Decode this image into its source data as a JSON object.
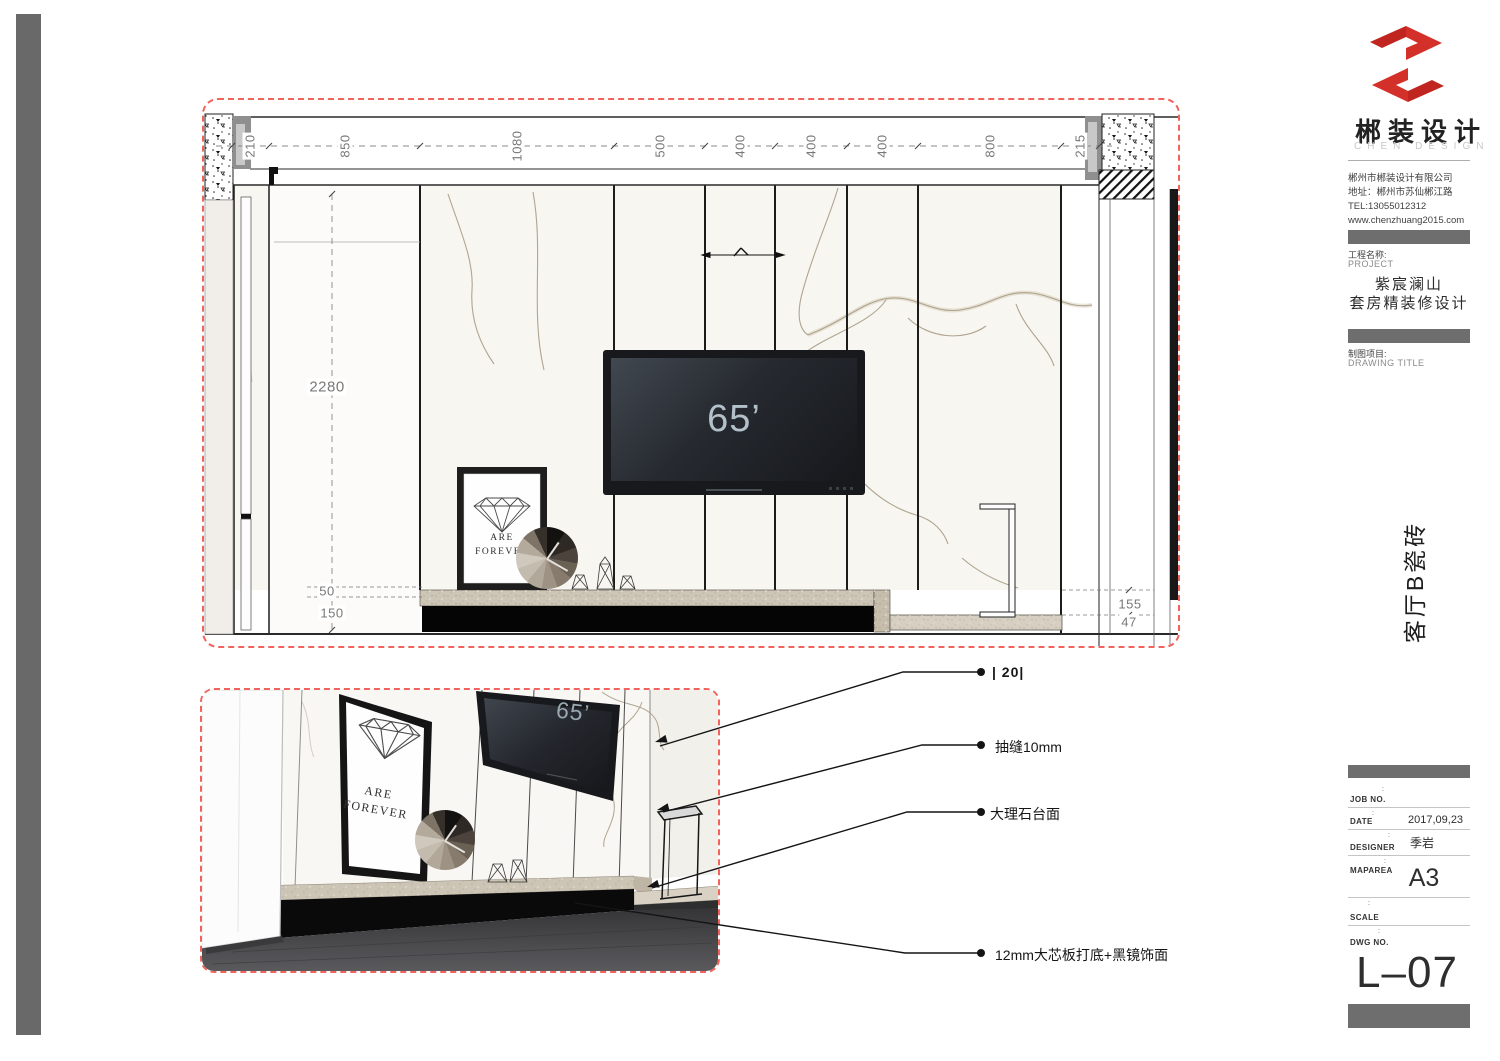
{
  "sidebar": {
    "brand": "郴装设计",
    "brand_en": "CHEN DESIGN",
    "company": [
      "郴州市郴装设计有限公司",
      "地址：郴州市苏仙郴江路",
      "TEL:13055012312",
      "www.chenzhuang2015.com"
    ],
    "project_label_cn": "工程名称:",
    "project_label_en": "PROJECT",
    "project_name": [
      "紫宸澜山",
      "套房精装修设计"
    ],
    "drawing_label_cn": "制图项目:",
    "drawing_label_en": "DRAWING TITLE",
    "drawing_title": "客厅B瓷砖",
    "titleblock": {
      "rows": [
        {
          "tick": ":",
          "label": "JOB NO.",
          "value": ""
        },
        {
          "tick": ":",
          "label": "DATE",
          "value": "2017,09,23"
        },
        {
          "tick": ":",
          "label": "DESIGNER",
          "value": "季岩"
        },
        {
          "tick": ":",
          "label": "MAPAREA",
          "value": "A3"
        },
        {
          "tick": ":",
          "label": "SCALE",
          "value": ""
        },
        {
          "tick": ":",
          "label": "DWG NO.",
          "value": ""
        }
      ],
      "dwg_number": "L–07"
    }
  },
  "elevation": {
    "dims_top": [
      "210",
      "850",
      "1080",
      "500",
      "400",
      "400",
      "400",
      "800",
      "215"
    ],
    "dim_height": "2280",
    "dim_counter_h1": "50",
    "dim_counter_h2": "150",
    "dim_right_1": "155",
    "dim_right_2": "47",
    "tv_label": "65’"
  },
  "perspective": {
    "tv_label": "65’"
  },
  "artwork": {
    "line1": "ARE",
    "line2": "FOREVER"
  },
  "annotations": [
    {
      "text": "|  20|"
    },
    {
      "text": "抽缝10mm"
    },
    {
      "text": "大理石台面"
    },
    {
      "text": "12mm大芯板打底+黑镜饰面"
    }
  ],
  "colors": {
    "accent_red": "#f2635c",
    "logo_red": "#d3302a",
    "bar_gray": "#6e6e6e"
  }
}
